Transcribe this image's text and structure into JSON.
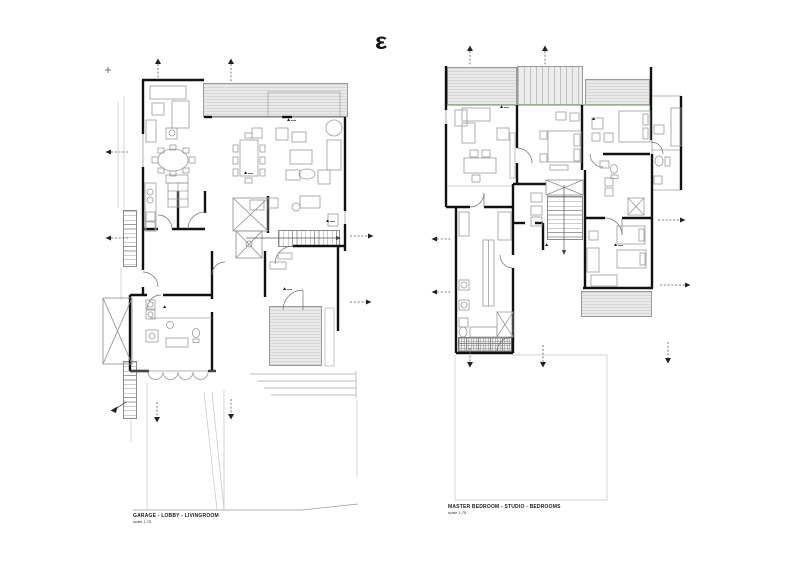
{
  "logo": {
    "glyph": "ε"
  },
  "plans": [
    {
      "id": "plan-ground",
      "label": "GARAGE - LOBBY - LIVINGROOM",
      "scale_note": "scale 1:75"
    },
    {
      "id": "plan-upper",
      "label": "MASTER BEDROOM - STUDIO - BEDROOMS",
      "scale_note": "scale 1:75"
    }
  ],
  "colors": {
    "wall": "#111111",
    "furniture_line": "#9b9b9b",
    "hatch_fill": "#e9e9e9",
    "hatch_line": "#c2c2c2",
    "accent_green": "#9cb292",
    "site_line": "#c4c4c4",
    "marker": "#222222"
  }
}
